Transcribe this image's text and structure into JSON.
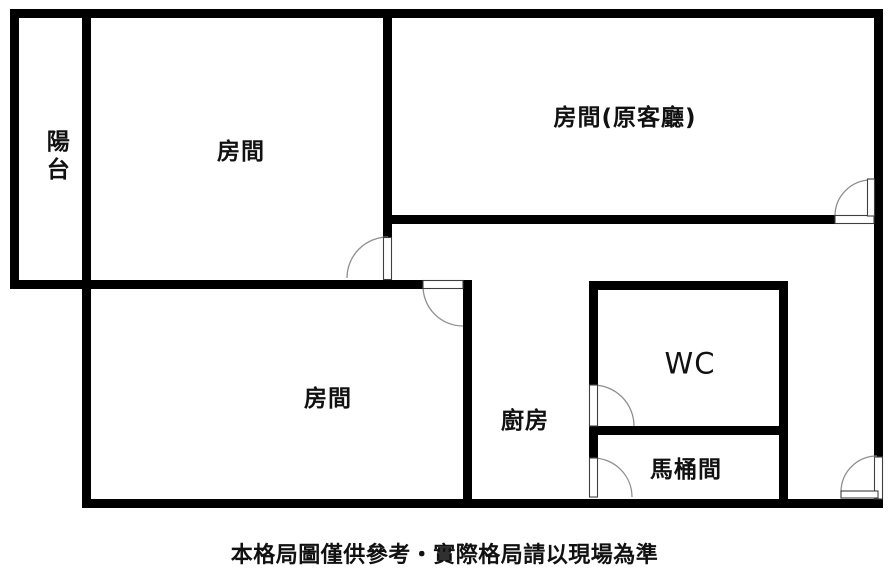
{
  "rooms": [
    {
      "name": "balcony",
      "label": "陽台"
    },
    {
      "name": "bedroom-upper-left",
      "label": "房間"
    },
    {
      "name": "bedroom-former-living-room",
      "label": "房間(原客廳)"
    },
    {
      "name": "bedroom-lower-left",
      "label": "房間"
    },
    {
      "name": "kitchen",
      "label": "廚房"
    },
    {
      "name": "wc",
      "label": "WC"
    },
    {
      "name": "toilet-room",
      "label": "馬桶間"
    }
  ],
  "footer": {
    "caption": "本格局圖僅供參考・實際格局請以現場為準"
  },
  "colors": {
    "wall": "#000000",
    "floor": "#ffffff",
    "door_arc": "#8f8f8f",
    "door_leaf_outline": "#3f3f3f",
    "label_text": "#111111"
  }
}
